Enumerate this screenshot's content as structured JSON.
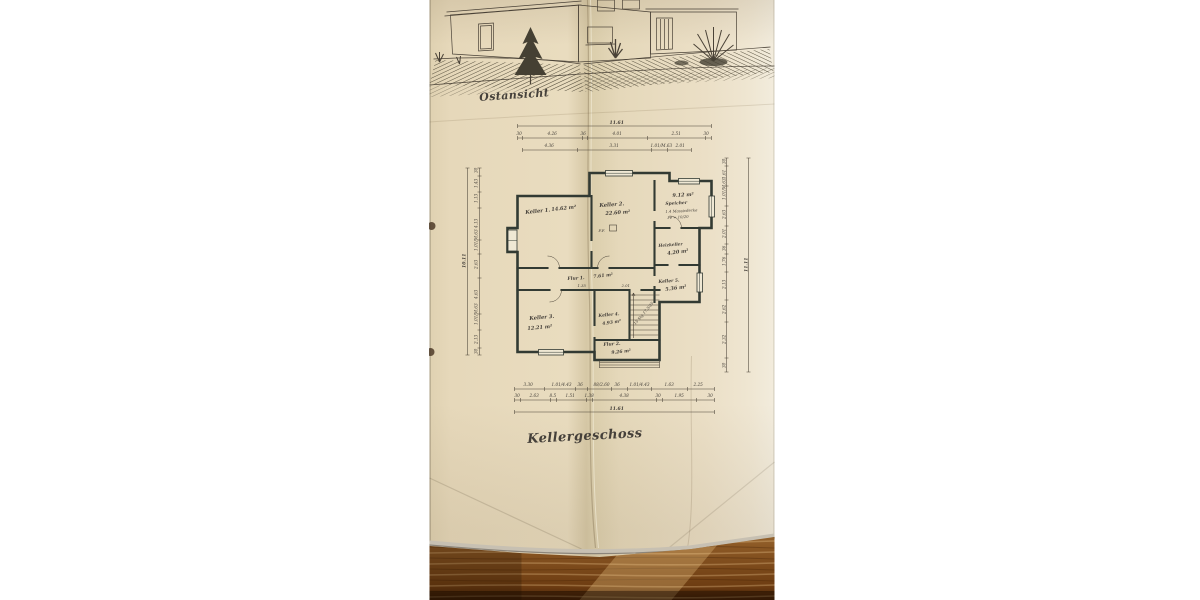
{
  "photo": {
    "caption_top": "Ostansicht",
    "caption_bottom": "Kellergeschoss",
    "plan": {
      "rooms": [
        {
          "name": "Keller 1.",
          "area": "14.62 m²"
        },
        {
          "name": "Keller 2.",
          "area": "22.60 m²"
        },
        {
          "name": "Speicher",
          "area": "9.12 m²"
        },
        {
          "name": "Heizkeller",
          "area": "4.20 m²"
        },
        {
          "name": "Keller 5.",
          "area": "5.36 m²"
        },
        {
          "name": "Keller 3.",
          "area": "12.21 m²"
        },
        {
          "name": "Keller 4.",
          "area": "4.93 m²"
        },
        {
          "name": "Flur 1.",
          "area": "7.61 m²"
        },
        {
          "name": "Flur 2.",
          "area": "9.26 m²"
        }
      ],
      "stair_note": "15 Stg 17,5/25",
      "ff_mark": "F.F.",
      "slab_note_1": "1.4 Massivdecke",
      "slab_note_2": "Fe = 10/20",
      "inner_dims": [
        "1.35",
        "2.01"
      ]
    },
    "dims": {
      "top": {
        "total": "11.61",
        "row2": [
          "30",
          "4.26",
          "36",
          "4.01",
          "2.51",
          "30"
        ],
        "row3": [
          "4.36",
          "3.31",
          "1.01/M.63",
          "2.01"
        ]
      },
      "bottom": {
        "total": "11.61",
        "row1": [
          "3.30",
          "1.01/4.43",
          "36",
          "88/2.60",
          "36",
          "1.01/4.43",
          "1.63",
          "2.25"
        ],
        "row2": [
          "30",
          "2.63",
          "8.5",
          "1.51",
          "1.38",
          "4.38",
          "30",
          "1.95",
          "30"
        ]
      },
      "left": {
        "total": "10.11",
        "vals": [
          "30",
          "1.43",
          "1.13",
          "4.13",
          "1.01/M.63",
          "2.63",
          "4.63",
          "1.01/M.63",
          "2.13",
          "30"
        ]
      },
      "right": {
        "total": "11.11",
        "vals": [
          "30",
          "1.61",
          "1.01/M.63",
          "2.63",
          "2.01",
          "36",
          "1.76",
          "2.13",
          "2.62",
          "2.32",
          "30"
        ]
      }
    },
    "colors": {
      "background": "#ffffff",
      "paper": "#e7dabd",
      "ink": "#45403a",
      "wall": "#323a33",
      "wood": "#7c4a1d"
    }
  }
}
